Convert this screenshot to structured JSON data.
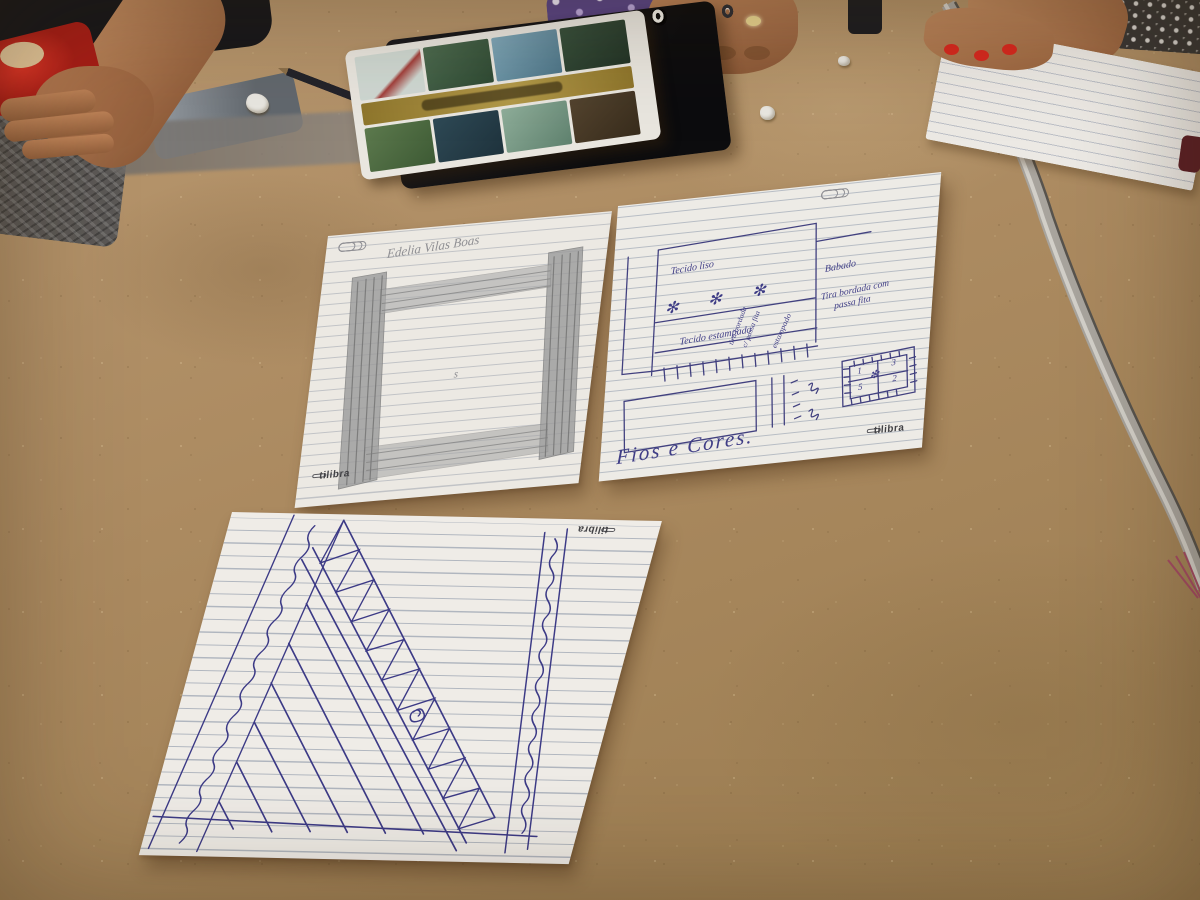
{
  "brand": "tilibra",
  "left_paper": {
    "title": "Edelia Vilas Boas",
    "stray_mark": "s"
  },
  "right_paper": {
    "tecido_liso": "Tecido liso",
    "babado": "Babado",
    "tira_line1": "Tira bordada com",
    "tira_line2": "passa fita",
    "tecido_estampado": "Tecido estampado",
    "vert_label1": "tira bordada",
    "vert_label2": "c/ passa fita",
    "vert_label3": "estampado",
    "flower": "✻",
    "quilt": {
      "n1": "1",
      "n2": "3",
      "n3": "5",
      "n4": "2"
    },
    "signature": "Fios e Cores."
  },
  "colors": {
    "table": "#ad8a60",
    "pen_ink": "#3c3a86",
    "pencil_sketch": "#9a9a9a",
    "red_object": "#d03025",
    "nail_polish": "#d6281f",
    "notebook_gold_band": "#a08634",
    "metal_bar": "#a8a49d",
    "skin": "#b37a55"
  }
}
